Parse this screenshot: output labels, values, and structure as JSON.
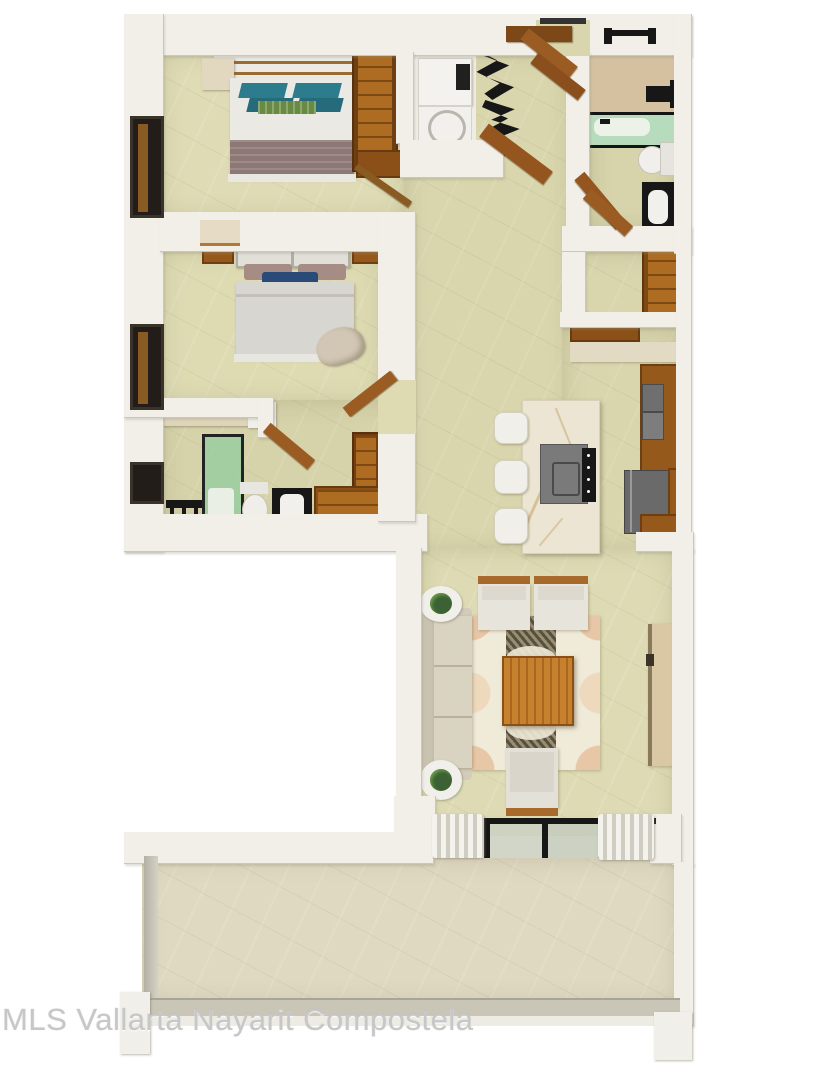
{
  "watermark": {
    "text": "MLS Vallarta Nayarit Compostela"
  },
  "palette": {
    "background": "#ffffff",
    "wall": "#f2efe9",
    "floor_bedroom": "#dfdcb5",
    "floor_hall": "#d9d5ad",
    "floor_bathroom_accent": "#d5c1a0",
    "floor_terrace": "#e0d9c2",
    "wood": "#96591c",
    "wood_light": "#ad6c22",
    "dark_fixture": "#171717",
    "teal_pillow": "#2d7c8e",
    "green_pillow": "#688a42",
    "navy_pillow": "#2a4a78",
    "mauve_blanket": "#8d7876",
    "shower_glass_green": "#a9d3ae",
    "marble_island": "#ece5d3",
    "appliance_gray": "#757575",
    "sofa_beige": "#d9d3c1",
    "rug_runner": "#57503e",
    "coffee_table_wood": "#c6812f",
    "railing_gray": "#c9c6b7"
  },
  "plan": {
    "type": "apartment-floor-plan-3d-top-view",
    "rooms": [
      {
        "name": "bedroom-1",
        "furniture": [
          "double-bed",
          "teal-pillows",
          "green-pillow",
          "mauve-blanket",
          "canopy",
          "dresser",
          "wardrobe",
          "window"
        ]
      },
      {
        "name": "bedroom-2",
        "furniture": [
          "double-bed",
          "mauve-pillows",
          "navy-pillow",
          "headboard",
          "nightstands",
          "accent-chair",
          "window"
        ]
      },
      {
        "name": "bathroom-2",
        "furniture": [
          "glass-shower",
          "shower-fixture",
          "toilet",
          "vanity-sink",
          "bench",
          "side-table",
          "wardrobe",
          "window"
        ]
      },
      {
        "name": "laundry-closet",
        "furniture": [
          "washer",
          "dryer",
          "black-folding-doors"
        ]
      },
      {
        "name": "entry",
        "furniture": [
          "entry-door",
          "door-threshold"
        ]
      },
      {
        "name": "bathroom-1",
        "furniture": [
          "bathtub-shower",
          "shower-head",
          "toilet",
          "vanity-sink",
          "window",
          "wood-threshold"
        ]
      },
      {
        "name": "walk-in-closet",
        "furniture": [
          "wood-shelving",
          "door"
        ]
      },
      {
        "name": "kitchen",
        "furniture": [
          "marble-island",
          "bar-stools",
          "cooktop",
          "range-panel",
          "wall-ovens",
          "refrigerator",
          "cabinets",
          "counter"
        ]
      },
      {
        "name": "living-room",
        "furniture": [
          "sofa",
          "armchairs",
          "coffee-table",
          "patterned-rug",
          "tv-console",
          "plant-side-tables",
          "sliding-glass-door",
          "curtains"
        ]
      },
      {
        "name": "terrace",
        "furniture": [
          "railing",
          "corner-posts"
        ]
      }
    ]
  }
}
